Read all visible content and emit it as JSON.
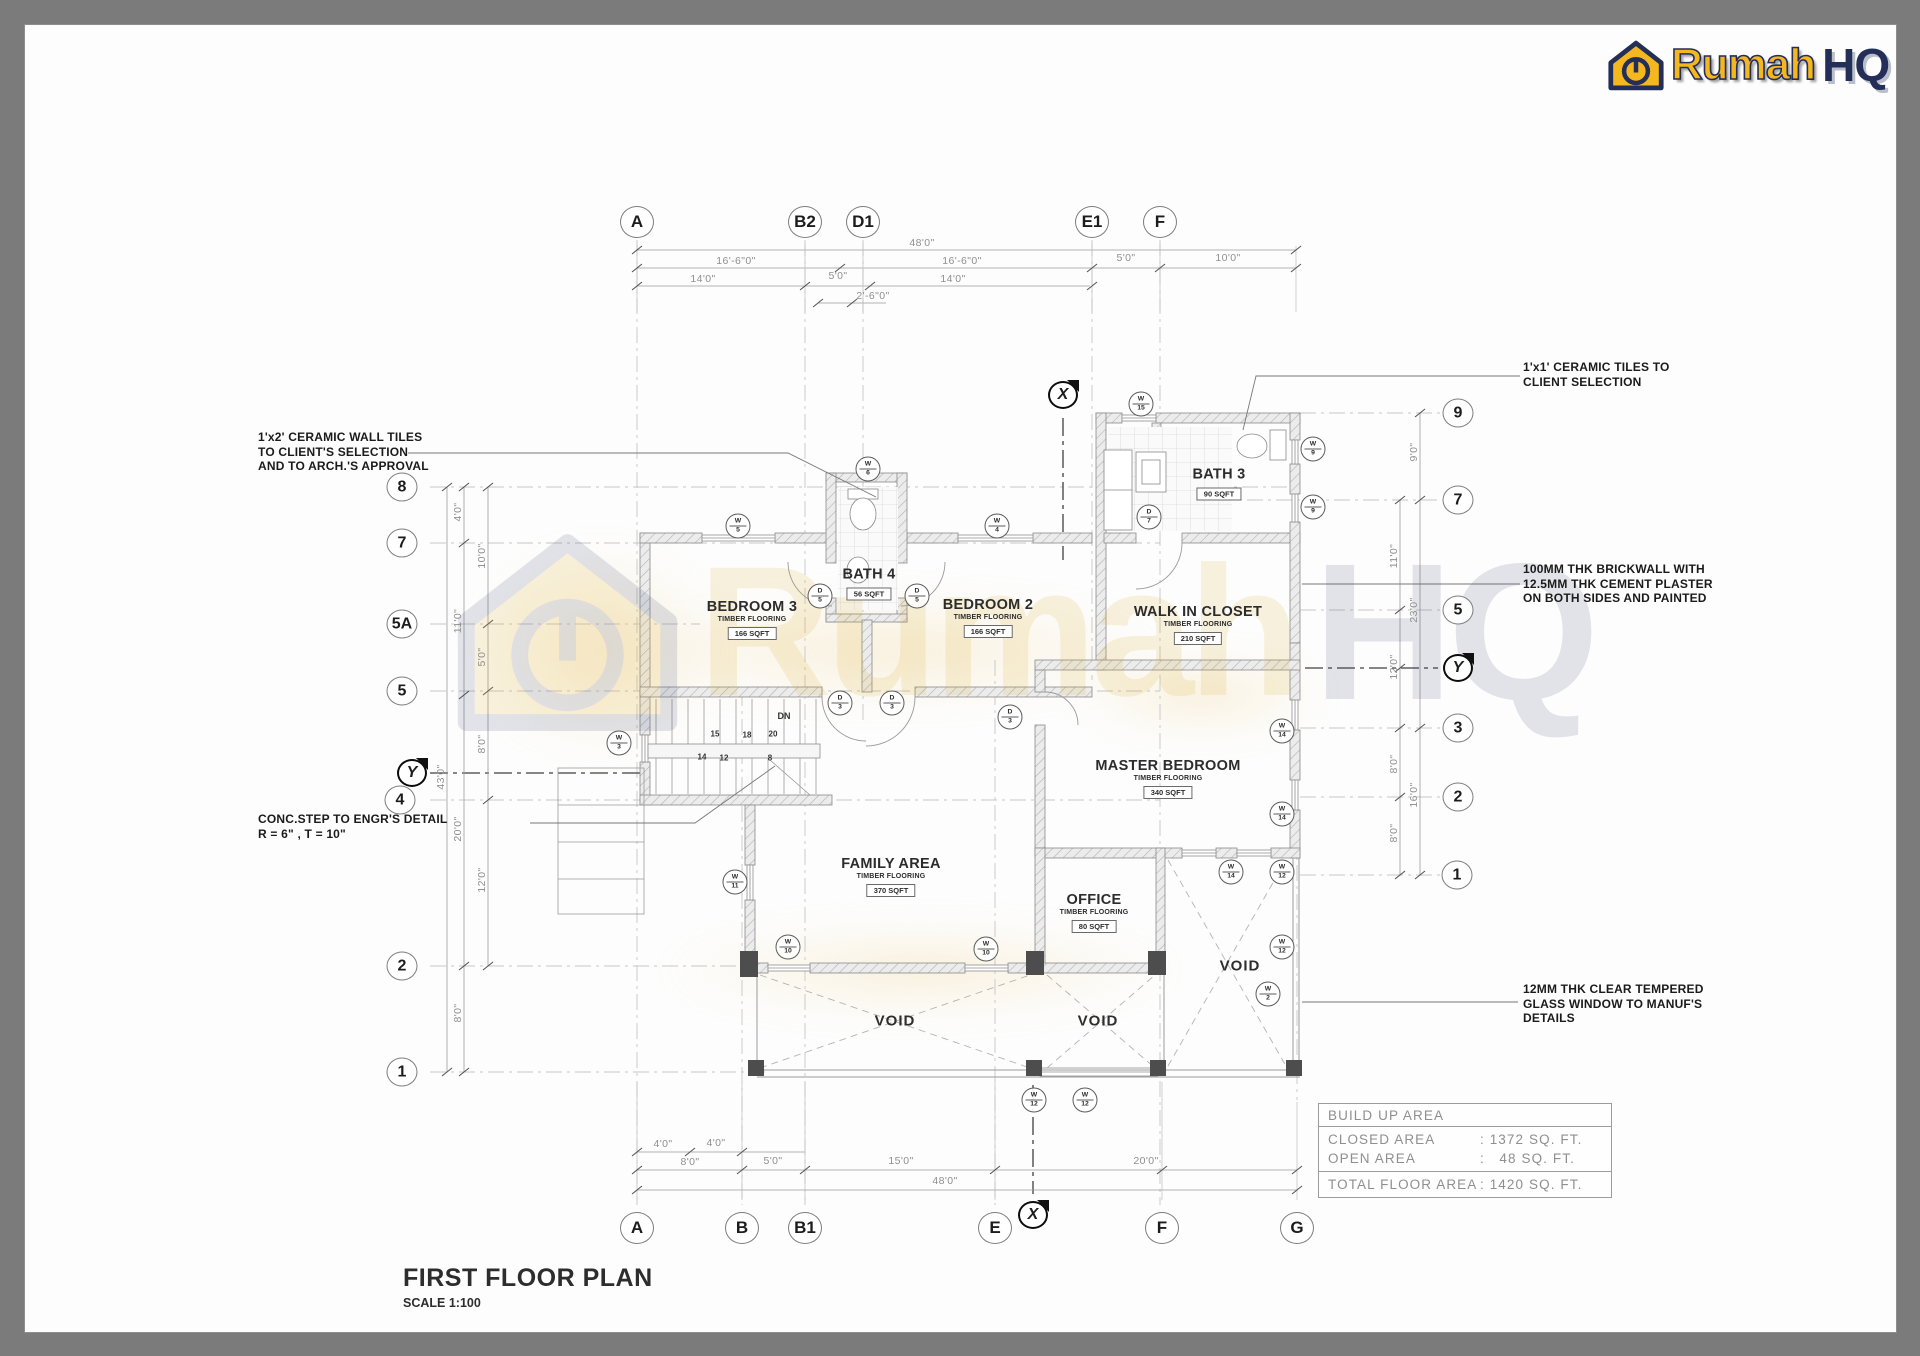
{
  "logo": {
    "rumah": "Rumah",
    "hq": "HQ"
  },
  "watermark": {
    "rumah": "Rumah",
    "hq": "HQ"
  },
  "title_block": {
    "title": "FIRST FLOOR PLAN",
    "scale": "SCALE 1:100"
  },
  "area_table": {
    "header": "BUILD UP AREA",
    "rows": [
      {
        "label": "CLOSED AREA",
        "value": ": 1372 SQ. FT."
      },
      {
        "label": "OPEN AREA",
        "value": ":   48 SQ. FT."
      }
    ],
    "total": {
      "label": "TOTAL FLOOR AREA",
      "value": ": 1420 SQ. FT."
    }
  },
  "annotations": [
    {
      "lines": [
        "1'x2' CERAMIC WALL TILES",
        "TO CLIENT'S SELECTION",
        "AND TO ARCH.'S APPROVAL"
      ],
      "x": 258,
      "y": 430
    },
    {
      "lines": [
        "CONC.STEP TO ENGR'S DETAIL",
        "R = 6\" , T = 10\"",
        ""
      ],
      "x": 258,
      "y": 812
    },
    {
      "lines": [
        "1'x1' CERAMIC TILES TO",
        "CLIENT SELECTION",
        ""
      ],
      "x": 1523,
      "y": 360
    },
    {
      "lines": [
        "100MM THK BRICKWALL WITH",
        "12.5MM THK CEMENT PLASTER",
        "ON BOTH SIDES AND PAINTED"
      ],
      "x": 1523,
      "y": 562
    },
    {
      "lines": [
        "12MM THK CLEAR TEMPERED",
        "GLASS WINDOW TO MANUF'S",
        "DETAILS"
      ],
      "x": 1523,
      "y": 982
    }
  ],
  "rooms": [
    {
      "name": "BEDROOM 3",
      "floor": "TIMBER FLOORING",
      "area": "166 SQFT",
      "x": 752,
      "y": 620
    },
    {
      "name": "BATH 4",
      "floor": "",
      "area": "56 SQFT",
      "x": 869,
      "y": 584
    },
    {
      "name": "BEDROOM 2",
      "floor": "TIMBER FLOORING",
      "area": "166 SQFT",
      "x": 988,
      "y": 618
    },
    {
      "name": "BATH 3",
      "floor": "",
      "area": "90 SQFT",
      "x": 1219,
      "y": 484
    },
    {
      "name": "WALK IN CLOSET",
      "floor": "TIMBER FLOORING",
      "area": "210 SQFT",
      "x": 1198,
      "y": 625
    },
    {
      "name": "MASTER BEDROOM",
      "floor": "TIMBER FLOORING",
      "area": "340 SQFT",
      "x": 1168,
      "y": 779
    },
    {
      "name": "OFFICE",
      "floor": "TIMBER FLOORING",
      "area": "80 SQFT",
      "x": 1094,
      "y": 913
    },
    {
      "name": "FAMILY AREA",
      "floor": "TIMBER FLOORING",
      "area": "370 SQFT",
      "x": 891,
      "y": 877
    }
  ],
  "voids": [
    {
      "label": "VOID",
      "x": 895,
      "y": 1021
    },
    {
      "label": "VOID",
      "x": 1098,
      "y": 1021
    },
    {
      "label": "VOID",
      "x": 1240,
      "y": 966
    }
  ],
  "grid_bubbles": {
    "top": [
      {
        "label": "A",
        "x": 637,
        "y": 222
      },
      {
        "label": "B2",
        "x": 805,
        "y": 222
      },
      {
        "label": "D1",
        "x": 863,
        "y": 222
      },
      {
        "label": "E1",
        "x": 1092,
        "y": 222
      },
      {
        "label": "F",
        "x": 1160,
        "y": 222
      }
    ],
    "bottom": [
      {
        "label": "A",
        "x": 637,
        "y": 1228
      },
      {
        "label": "B",
        "x": 742,
        "y": 1228
      },
      {
        "label": "B1",
        "x": 805,
        "y": 1228
      },
      {
        "label": "E",
        "x": 995,
        "y": 1228
      },
      {
        "label": "F",
        "x": 1162,
        "y": 1228
      },
      {
        "label": "G",
        "x": 1297,
        "y": 1228
      }
    ],
    "left": [
      {
        "label": "8",
        "x": 402,
        "y": 487
      },
      {
        "label": "7",
        "x": 402,
        "y": 543
      },
      {
        "label": "5A",
        "x": 402,
        "y": 624
      },
      {
        "label": "5",
        "x": 402,
        "y": 691
      },
      {
        "label": "4",
        "x": 400,
        "y": 800
      },
      {
        "label": "2",
        "x": 402,
        "y": 966
      },
      {
        "label": "1",
        "x": 402,
        "y": 1072
      }
    ],
    "right": [
      {
        "label": "9",
        "x": 1458,
        "y": 413
      },
      {
        "label": "7",
        "x": 1458,
        "y": 500
      },
      {
        "label": "5",
        "x": 1458,
        "y": 610
      },
      {
        "label": "3",
        "x": 1458,
        "y": 728
      },
      {
        "label": "2",
        "x": 1458,
        "y": 797
      },
      {
        "label": "1",
        "x": 1457,
        "y": 875
      }
    ]
  },
  "section_markers": [
    {
      "label": "X",
      "x": 1063,
      "y": 395
    },
    {
      "label": "Y",
      "x": 412,
      "y": 773
    },
    {
      "label": "Y",
      "x": 1458,
      "y": 668
    },
    {
      "label": "X",
      "x": 1033,
      "y": 1215
    }
  ],
  "dimensions": {
    "top": [
      {
        "t": "48'0\"",
        "x": 922,
        "y": 243
      },
      {
        "t": "16'-6\"0\"",
        "x": 736,
        "y": 261
      },
      {
        "t": "16'-6\"0\"",
        "x": 962,
        "y": 261
      },
      {
        "t": "5'0\"",
        "x": 1126,
        "y": 258
      },
      {
        "t": "10'0\"",
        "x": 1228,
        "y": 258
      },
      {
        "t": "14'0\"",
        "x": 703,
        "y": 279
      },
      {
        "t": "5'0\"",
        "x": 838,
        "y": 276
      },
      {
        "t": "14'0\"",
        "x": 953,
        "y": 279
      },
      {
        "t": "2'-6\"0\"",
        "x": 873,
        "y": 296
      }
    ],
    "bottom": [
      {
        "t": "4'0\"",
        "x": 663,
        "y": 1144
      },
      {
        "t": "4'0\"",
        "x": 716,
        "y": 1143
      },
      {
        "t": "8'0\"",
        "x": 690,
        "y": 1162
      },
      {
        "t": "5'0\"",
        "x": 773,
        "y": 1161
      },
      {
        "t": "15'0\"",
        "x": 901,
        "y": 1161
      },
      {
        "t": "20'0\"",
        "x": 1146,
        "y": 1161
      },
      {
        "t": "48'0\"",
        "x": 945,
        "y": 1181
      }
    ],
    "left": [
      {
        "t": "4'0\"",
        "x": 458,
        "y": 512,
        "rot": -90
      },
      {
        "t": "10'0\"",
        "x": 482,
        "y": 556,
        "rot": -90
      },
      {
        "t": "11'0\"",
        "x": 458,
        "y": 621,
        "rot": -90
      },
      {
        "t": "5'0\"",
        "x": 482,
        "y": 657,
        "rot": -90
      },
      {
        "t": "8'0\"",
        "x": 482,
        "y": 744,
        "rot": -90
      },
      {
        "t": "43'0\"",
        "x": 441,
        "y": 777,
        "rot": -90
      },
      {
        "t": "20'0\"",
        "x": 458,
        "y": 829,
        "rot": -90
      },
      {
        "t": "12'0\"",
        "x": 482,
        "y": 880,
        "rot": -90
      },
      {
        "t": "8'0\"",
        "x": 458,
        "y": 1013,
        "rot": -90
      }
    ],
    "right": [
      {
        "t": "9'0\"",
        "x": 1414,
        "y": 452,
        "rot": -90
      },
      {
        "t": "11'0\"",
        "x": 1394,
        "y": 556,
        "rot": -90
      },
      {
        "t": "23'0\"",
        "x": 1414,
        "y": 610,
        "rot": -90
      },
      {
        "t": "12'0\"",
        "x": 1394,
        "y": 667,
        "rot": -90
      },
      {
        "t": "8'0\"",
        "x": 1394,
        "y": 764,
        "rot": -90
      },
      {
        "t": "16'0\"",
        "x": 1414,
        "y": 795,
        "rot": -90
      },
      {
        "t": "8'0\"",
        "x": 1394,
        "y": 833,
        "rot": -90
      }
    ]
  },
  "tags": [
    {
      "t": "W",
      "n": "15",
      "x": 1141,
      "y": 404
    },
    {
      "t": "W",
      "n": "6",
      "x": 868,
      "y": 469
    },
    {
      "t": "W",
      "n": "5",
      "x": 738,
      "y": 526
    },
    {
      "t": "W",
      "n": "4",
      "x": 997,
      "y": 526
    },
    {
      "t": "W",
      "n": "9",
      "x": 1313,
      "y": 449
    },
    {
      "t": "W",
      "n": "9",
      "x": 1313,
      "y": 507
    },
    {
      "t": "D",
      "n": "7",
      "x": 1149,
      "y": 517
    },
    {
      "t": "D",
      "n": "5",
      "x": 820,
      "y": 596
    },
    {
      "t": "D",
      "n": "5",
      "x": 917,
      "y": 596
    },
    {
      "t": "D",
      "n": "3",
      "x": 840,
      "y": 703
    },
    {
      "t": "D",
      "n": "3",
      "x": 892,
      "y": 703
    },
    {
      "t": "D",
      "n": "3",
      "x": 1010,
      "y": 717
    },
    {
      "t": "W",
      "n": "3",
      "x": 619,
      "y": 743
    },
    {
      "t": "W",
      "n": "11",
      "x": 735,
      "y": 882
    },
    {
      "t": "W",
      "n": "10",
      "x": 788,
      "y": 947
    },
    {
      "t": "W",
      "n": "10",
      "x": 986,
      "y": 949
    },
    {
      "t": "W",
      "n": "14",
      "x": 1282,
      "y": 731
    },
    {
      "t": "W",
      "n": "14",
      "x": 1282,
      "y": 814
    },
    {
      "t": "W",
      "n": "14",
      "x": 1231,
      "y": 872
    },
    {
      "t": "W",
      "n": "12",
      "x": 1282,
      "y": 872
    },
    {
      "t": "W",
      "n": "12",
      "x": 1282,
      "y": 947
    },
    {
      "t": "W",
      "n": "2",
      "x": 1268,
      "y": 994
    },
    {
      "t": "W",
      "n": "12",
      "x": 1034,
      "y": 1100
    },
    {
      "t": "W",
      "n": "12",
      "x": 1085,
      "y": 1100
    }
  ],
  "stair": {
    "numbers": [
      {
        "t": "15",
        "x": 715,
        "y": 734
      },
      {
        "t": "18",
        "x": 747,
        "y": 735
      },
      {
        "t": "20",
        "x": 773,
        "y": 734
      },
      {
        "t": "14",
        "x": 702,
        "y": 757
      },
      {
        "t": "12",
        "x": 724,
        "y": 758
      },
      {
        "t": "8",
        "x": 770,
        "y": 758
      },
      {
        "t": "DN",
        "x": 784,
        "y": 716,
        "cls": "dn"
      }
    ]
  }
}
